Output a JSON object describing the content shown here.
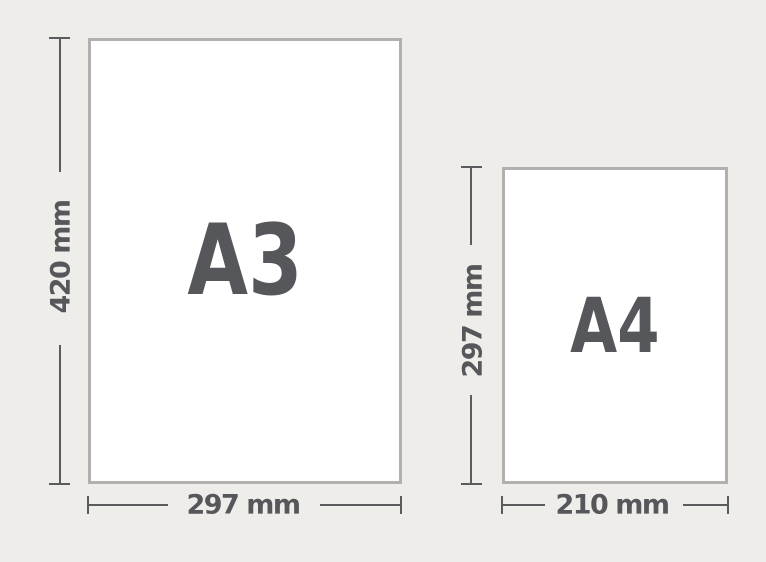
{
  "papers": [
    {
      "name": "A3",
      "height": "420 mm",
      "width": "297 mm"
    },
    {
      "name": "A4",
      "height": "297 mm",
      "width": "210 mm"
    }
  ],
  "colors": {
    "background": "#efede9",
    "paper_fill": "#ffffff",
    "paper_border": "#b2afae",
    "dimension_line": "#5a5b5d",
    "label_text": "#56575a"
  }
}
